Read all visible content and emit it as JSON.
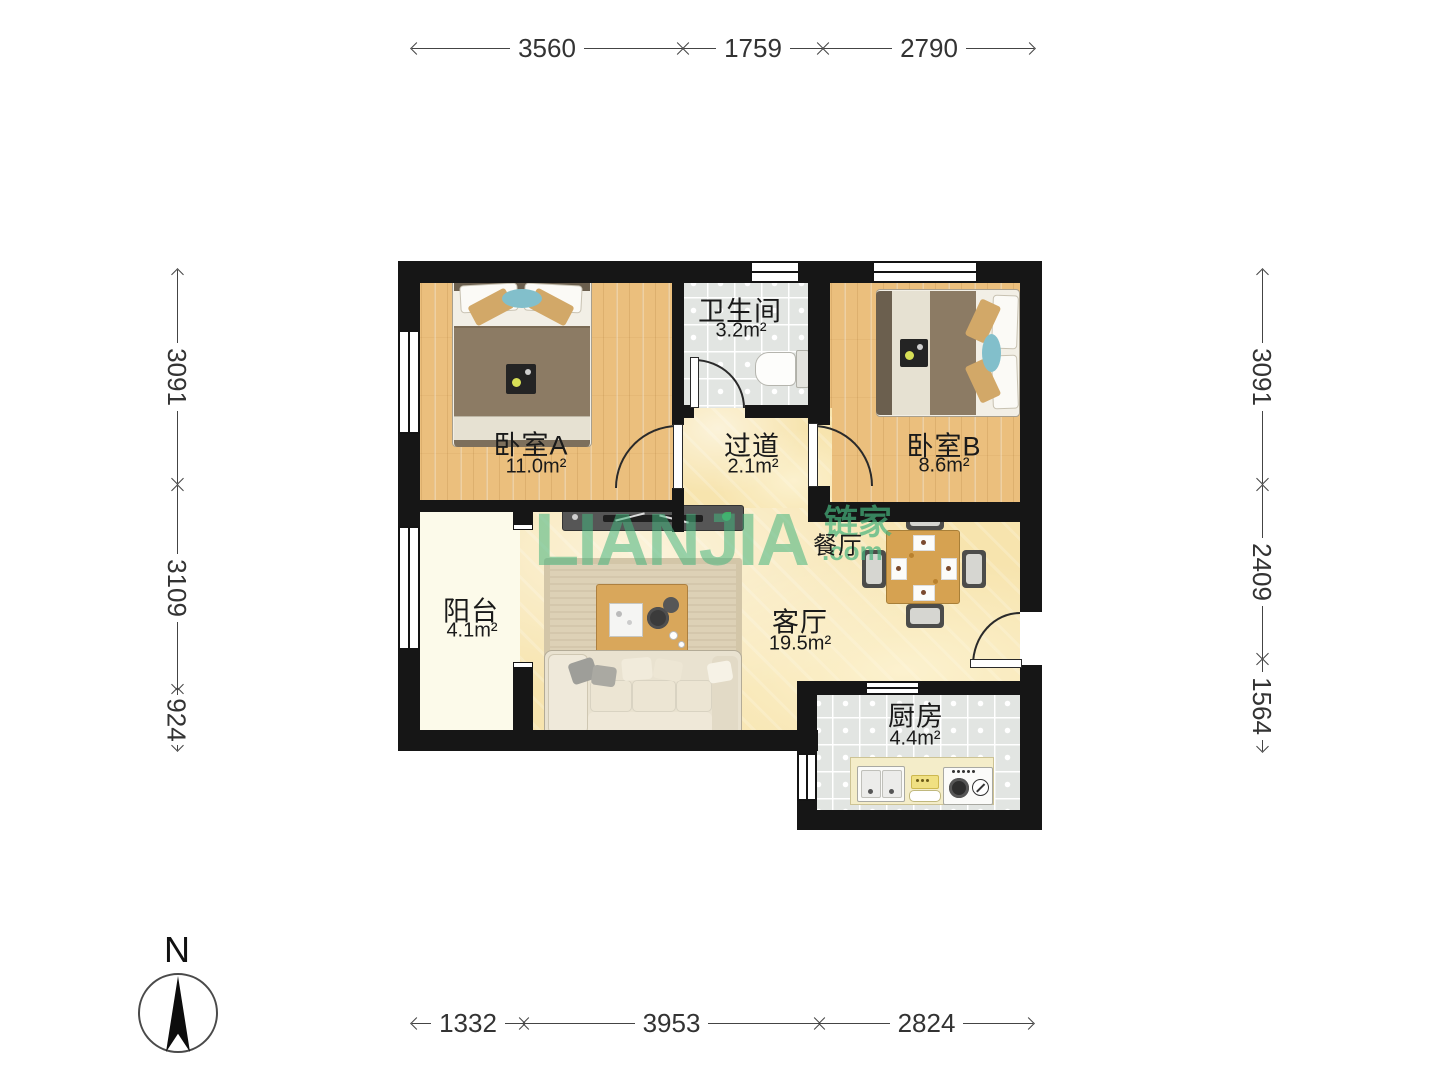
{
  "plan": {
    "rooms": {
      "bedroomA": {
        "name": "卧室A",
        "area": "11.0m²"
      },
      "bathroom": {
        "name": "卫生间",
        "area": "3.2m²"
      },
      "hallway": {
        "name": "过道",
        "area": "2.1m²"
      },
      "bedroomB": {
        "name": "卧室B",
        "area": "8.6m²"
      },
      "balcony": {
        "name": "阳台",
        "area": "4.1m²"
      },
      "living": {
        "name": "客厅",
        "area": "19.5m²"
      },
      "dining": {
        "name": "餐厅"
      },
      "kitchen": {
        "name": "厨房",
        "area": "4.4m²"
      }
    }
  },
  "dimensions": {
    "top": [
      {
        "value": "3560"
      },
      {
        "value": "1759"
      },
      {
        "value": "2790"
      }
    ],
    "bottom": [
      {
        "value": "1332"
      },
      {
        "value": "3953"
      },
      {
        "value": "2824"
      }
    ],
    "left": [
      {
        "value": "3091"
      },
      {
        "value": "3109"
      },
      {
        "value": "924"
      }
    ],
    "right": [
      {
        "value": "3091"
      },
      {
        "value": "2409"
      },
      {
        "value": "1564"
      }
    ]
  },
  "watermark": {
    "brand": "LIANJIA",
    "brand_cn": "链家",
    "domain": ".com",
    "color": "#46b47d"
  },
  "compass": {
    "label": "N"
  },
  "colors": {
    "wall": "#161616",
    "wood_floor": "#ebbf7d",
    "tile_floor": "#e2e5e2",
    "marble_floor": "#f7e4ae",
    "balcony_floor": "#fcfaea",
    "watermark_green": "#46b47d"
  }
}
